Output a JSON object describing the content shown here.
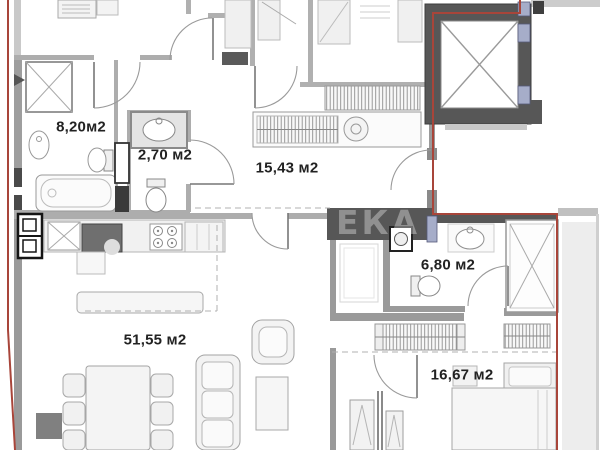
{
  "plan": {
    "watermark": {
      "text": "ЕКА"
    },
    "rooms": [
      {
        "id": "bathroom-main",
        "area_label": "8,20м2"
      },
      {
        "id": "wc",
        "area_label": "2,70 м2"
      },
      {
        "id": "hallway",
        "area_label": "15,43 м2"
      },
      {
        "id": "living-kitchen",
        "area_label": "51,55 м2"
      },
      {
        "id": "bathroom-second",
        "area_label": "6,80 м2"
      },
      {
        "id": "bedroom",
        "area_label": "16,67 м2"
      }
    ],
    "colors": {
      "boundary_red": "#a8453a",
      "wall_dark": "#575757",
      "wall_light": "#a6a6a6",
      "accent_blue": "#a6adc9",
      "label_text": "#222222",
      "watermark_text": "rgba(255,255,255,0.34)"
    }
  }
}
